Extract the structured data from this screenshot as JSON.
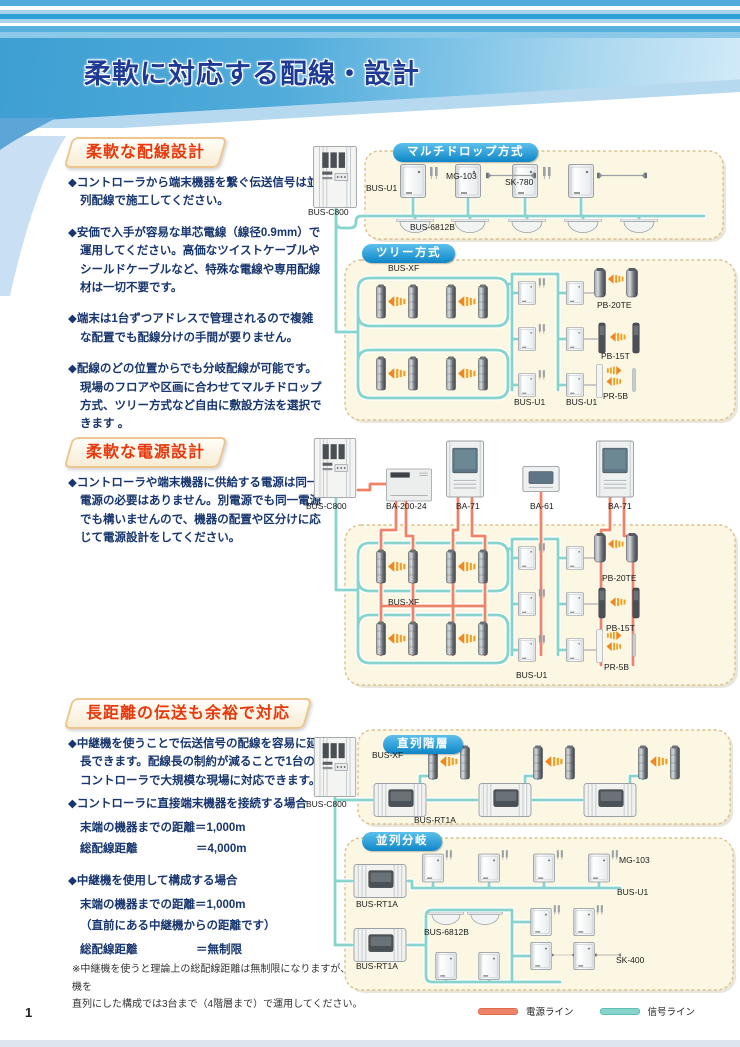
{
  "header": {
    "title": "柔軟に対応する配線・設計"
  },
  "sections": {
    "wiring": {
      "title": "柔軟な配線設計",
      "bullets": [
        "◆コントローラから端末機器を繋ぐ伝送信号は並列配線で施工してください。",
        "◆安価で入手が容易な単芯電線（線径0.9mm）で運用してください。高価なツイストケーブルやシールドケーブルなど、特殊な電線や専用配線材は一切不要です。",
        "◆端末は1台ずつアドレスで管理されるので複雑な配置でも配線分けの手間が要りません。",
        "◆配線のどの位置からでも分岐配線が可能です。現場のフロアや区画に合わせてマルチドロップ方式、ツリー方式など自由に敷設方法を選択できます 。"
      ]
    },
    "power": {
      "title": "柔軟な電源設計",
      "bullets": [
        "◆コントローラや端末機器に供給する電源は同一電源の必要はありません。別電源でも同一電源でも構いませんので、機器の配置や区分けに応じて電源設計をしてください。"
      ]
    },
    "distance": {
      "title": "長距離の伝送も余裕で対応",
      "intro": "◆中継機を使うことで伝送信号の配線を容易に延長できます。配線長の制約が減ることで1台のコントローラで大規模な現場に対応できます。",
      "case_direct": {
        "heading": "◆コントローラに直接端末機器を接続する場合",
        "line1": "末端の機器までの距離＝1,000m",
        "total_label": "総配線距離",
        "total_value": "＝4,000m"
      },
      "case_repeater": {
        "heading": "◆中継機を使用して構成する場合",
        "line1": "末端の機器までの距離＝1,000m",
        "line2": "（直前にある中継機からの距離です）",
        "total_label": "総配線距離",
        "total_value": "＝無制限"
      },
      "note": "※中継機を使うと理論上の総配線距離は無制限になりますが、中継機を\n直列にした構成では3台まで（4階層まで）で運用してください。"
    }
  },
  "diagrams": {
    "multidrop": {
      "badge": "マルチドロップ方式",
      "controller": "BUS-C800",
      "bus_u1": "BUS-U1",
      "mg103": "MG-103",
      "sk780": "SK-780",
      "bus6812b": "BUS-6812B"
    },
    "tree": {
      "badge": "ツリー方式",
      "bus_xf": "BUS-XF",
      "pb20te": "PB-20TE",
      "pb15t": "PB-15T",
      "pr5b": "PR-5B",
      "bus_u1_a": "BUS-U1",
      "bus_u1_b": "BUS-U1"
    },
    "power_supply": {
      "controller": "BUS-C800",
      "ba200": "BA-200-24",
      "ba71_a": "BA-71",
      "ba61": "BA-61",
      "ba71_b": "BA-71",
      "bus_xf": "BUS-XF",
      "bus_u1": "BUS-U1",
      "pb20te": "PB-20TE",
      "pb15t": "PB-15T",
      "pr5b": "PR-5B"
    },
    "serial": {
      "badge": "直列階層",
      "controller": "BUS-C800",
      "bus_xf": "BUS-XF",
      "bus_rt1a": "BUS-RT1A"
    },
    "parallel": {
      "badge": "並列分岐",
      "bus_rt1a_a": "BUS-RT1A",
      "bus_rt1a_b": "BUS-RT1A",
      "mg103": "MG-103",
      "bus_u1": "BUS-U1",
      "bus6812b": "BUS-6812B",
      "sk400": "SK-400"
    }
  },
  "legend": {
    "power_label": "電源ライン",
    "signal_label": "信号ライン"
  },
  "page_number": "1",
  "colors": {
    "power_line": "#ef8368",
    "signal_line": "#86d4cb",
    "accent_blue": "#1488cc",
    "heading_red": "#e8380d",
    "body_navy": "#17356e"
  }
}
